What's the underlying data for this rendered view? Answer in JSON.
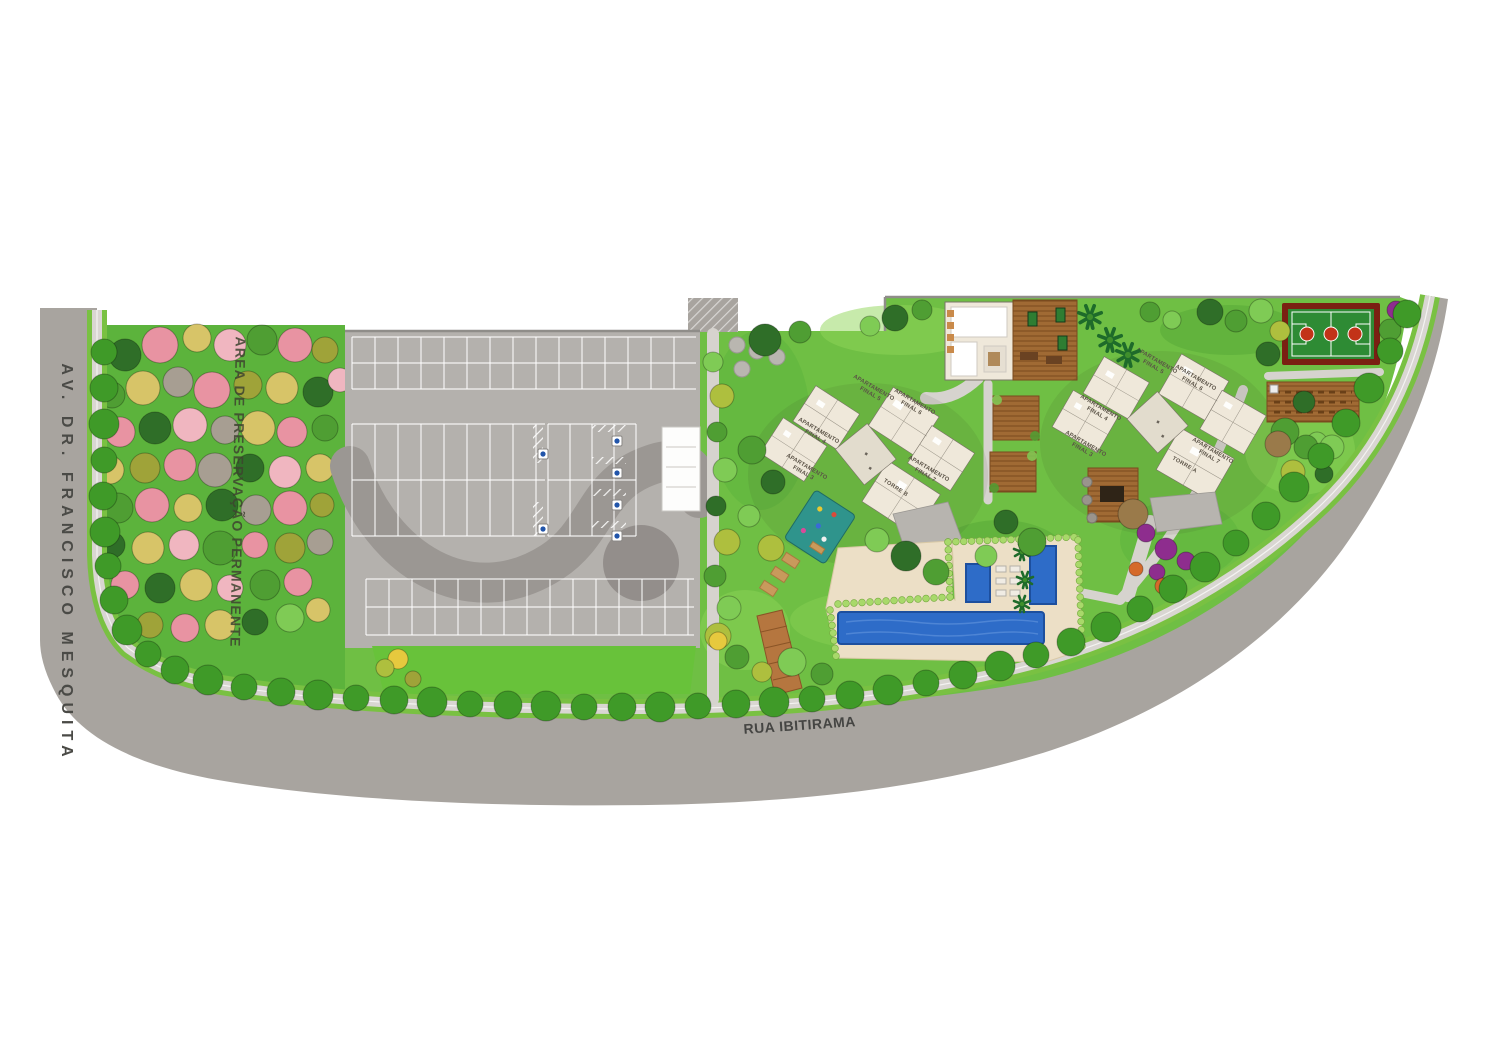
{
  "plan": {
    "title": "Implantação - site plan",
    "streets": {
      "left": "AV. DR. FRANCISCO MESQUITA",
      "bottom": "RUA IBITIRAMA"
    },
    "preservation_label": "AREA DE PRESERVAÇÃO PERMANENTE",
    "labels": {
      "apartamento": "APARTAMENTO",
      "final_3": "FINAL 3",
      "final_4": "FINAL 4",
      "final_5": "FINAL 5",
      "final_6": "FINAL 6",
      "final_7": "FINAL 7",
      "torre_a": "TORRE A",
      "torre_b": "TORRE B"
    },
    "palette": {
      "road": "#a8a49f",
      "parking": "#b4b1ad",
      "grass": "#6fbf44",
      "preservation_green": "#5cb33c",
      "building": "#efe8da",
      "pool_blue": "#2e6cc8",
      "wood_deck": "#a06a34",
      "court_green": "#2e8b34",
      "court_border": "#7a2012",
      "sidewalk": "#d9d6d2"
    }
  }
}
